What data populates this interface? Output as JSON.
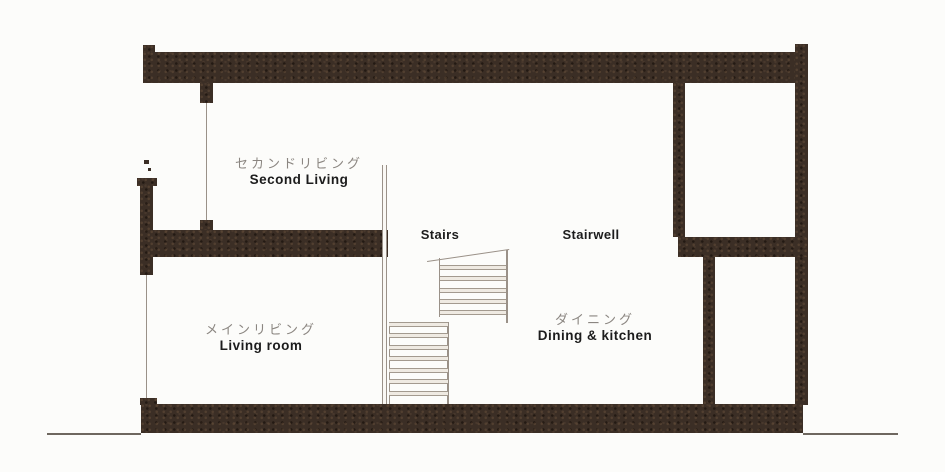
{
  "drawing": {
    "type": "architectural-section",
    "colors": {
      "wall_ink": "#3b2e25",
      "thin_line": "#9a9188",
      "ground_line": "#6e675f",
      "label_gray": "#8b8681",
      "label_black": "#1c1c1c",
      "background": "#fcfcfa"
    },
    "labels": {
      "second_living": {
        "jp": "セカンドリビング",
        "en": "Second Living"
      },
      "main_living": {
        "jp": "メインリビング",
        "en": "Living room"
      },
      "dining": {
        "jp": "ダイニング",
        "en": "Dining & kitchen"
      },
      "stairs": {
        "en": "Stairs"
      },
      "stairwell": {
        "en": "Stairwell"
      }
    }
  }
}
